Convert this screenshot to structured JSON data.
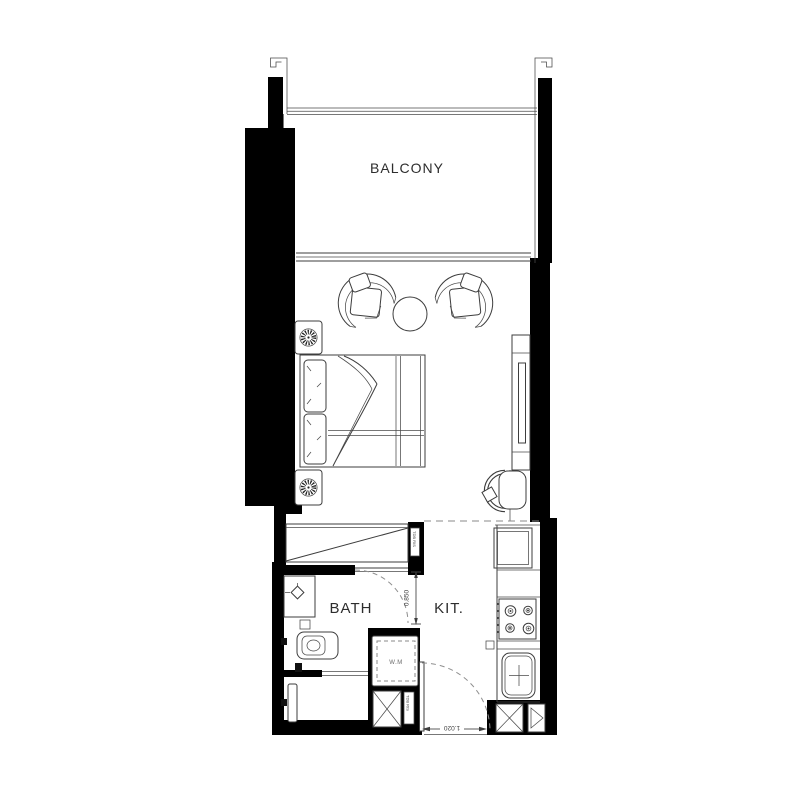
{
  "colors": {
    "walls": "#000000",
    "linework": "#3d3d3d",
    "dashed_lines": "#8a8a8a",
    "label_text": "#2d2d2d",
    "background": "#ffffff"
  },
  "rooms": {
    "balcony": {
      "label": "BALCONY"
    },
    "bath": {
      "label": "BATH"
    },
    "kitchen": {
      "label": "KIT."
    }
  },
  "appliances": {
    "washing_machine": {
      "label": "W.M"
    }
  },
  "dimensions": {
    "bath_passage": "0.850",
    "entry_door": "1.020"
  },
  "service_labels": {
    "riser_upper": "TDB RIS",
    "riser_lower": "TDB RIS"
  }
}
